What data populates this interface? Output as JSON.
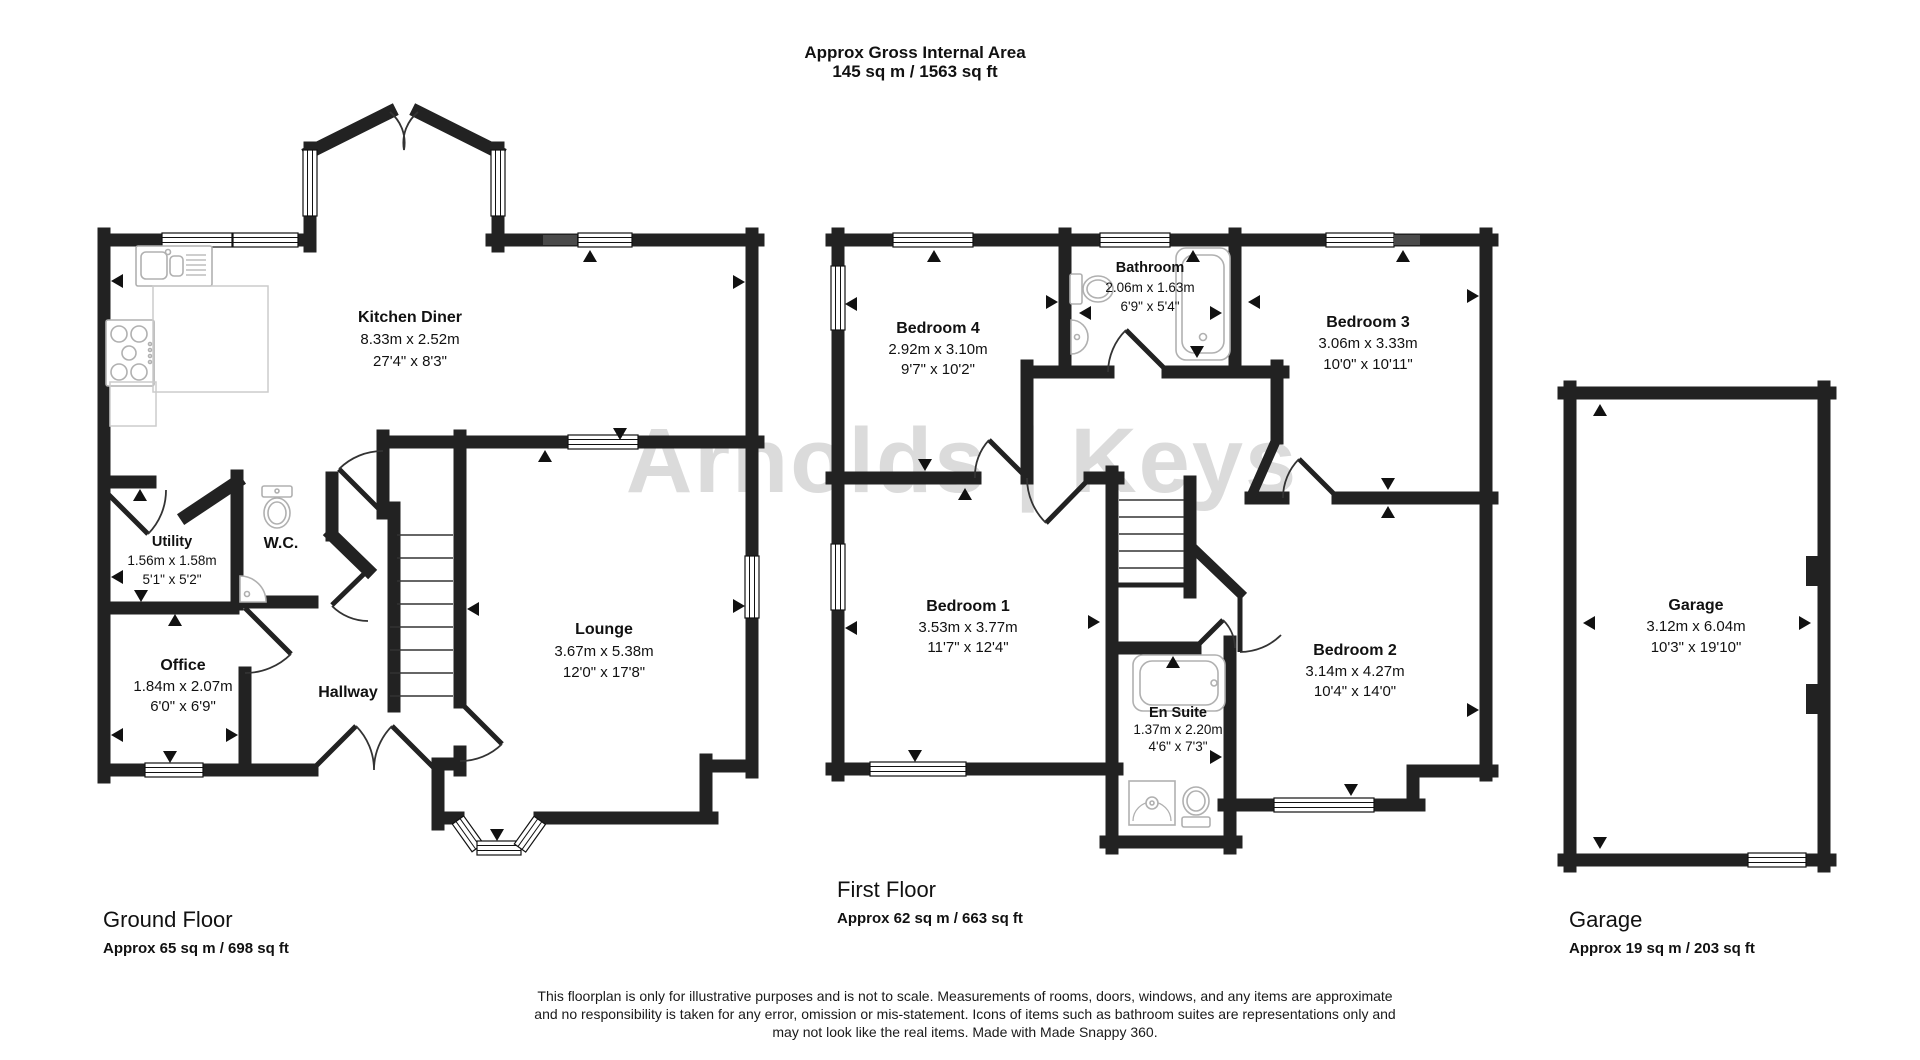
{
  "header": {
    "line1": "Approx Gross Internal Area",
    "line2": "145 sq m / 1563 sq ft"
  },
  "watermark": "Arnolds | Keys",
  "rooms": {
    "kitchen_diner": {
      "label": "Kitchen Diner",
      "metric": "8.33m x 2.52m",
      "imperial": "27'4\" x 8'3\""
    },
    "utility": {
      "label": "Utility",
      "metric": "1.56m x 1.58m",
      "imperial": "5'1\" x 5'2\""
    },
    "wc": {
      "label": "W.C."
    },
    "office": {
      "label": "Office",
      "metric": "1.84m x 2.07m",
      "imperial": "6'0\" x 6'9\""
    },
    "hallway": {
      "label": "Hallway"
    },
    "lounge": {
      "label": "Lounge",
      "metric": "3.67m x 5.38m",
      "imperial": "12'0\" x 17'8\""
    },
    "bedroom_4": {
      "label": "Bedroom 4",
      "metric": "2.92m x 3.10m",
      "imperial": "9'7\" x 10'2\""
    },
    "bathroom": {
      "label": "Bathroom",
      "metric": "2.06m x 1.63m",
      "imperial": "6'9\" x 5'4\""
    },
    "bedroom_3": {
      "label": "Bedroom 3",
      "metric": "3.06m x 3.33m",
      "imperial": "10'0\" x 10'11\""
    },
    "bedroom_1": {
      "label": "Bedroom 1",
      "metric": "3.53m x 3.77m",
      "imperial": "11'7\" x 12'4\""
    },
    "bedroom_2": {
      "label": "Bedroom 2",
      "metric": "3.14m x 4.27m",
      "imperial": "10'4\" x 14'0\""
    },
    "en_suite": {
      "label": "En Suite",
      "metric": "1.37m x 2.20m",
      "imperial": "4'6\" x 7'3\""
    },
    "garage": {
      "label": "Garage",
      "metric": "3.12m x 6.04m",
      "imperial": "10'3\" x 19'10\""
    }
  },
  "footer": {
    "ground": {
      "title": "Ground Floor",
      "area": "Approx 65 sq m / 698 sq ft"
    },
    "first": {
      "title": "First Floor",
      "area": "Approx 62 sq m / 663 sq ft"
    },
    "garage": {
      "title": "Garage",
      "area": "Approx 19 sq m / 203 sq ft"
    }
  },
  "disclaimer": {
    "line1": "This floorplan is only for illustrative purposes and is not to scale. Measurements of rooms, doors, windows, and any items are approximate",
    "line2": "and no responsibility is taken for any error, omission or mis-statement. Icons of items such as bathroom suites are representations only and",
    "line3": "may not look like the real items. Made with Made Snappy 360."
  }
}
